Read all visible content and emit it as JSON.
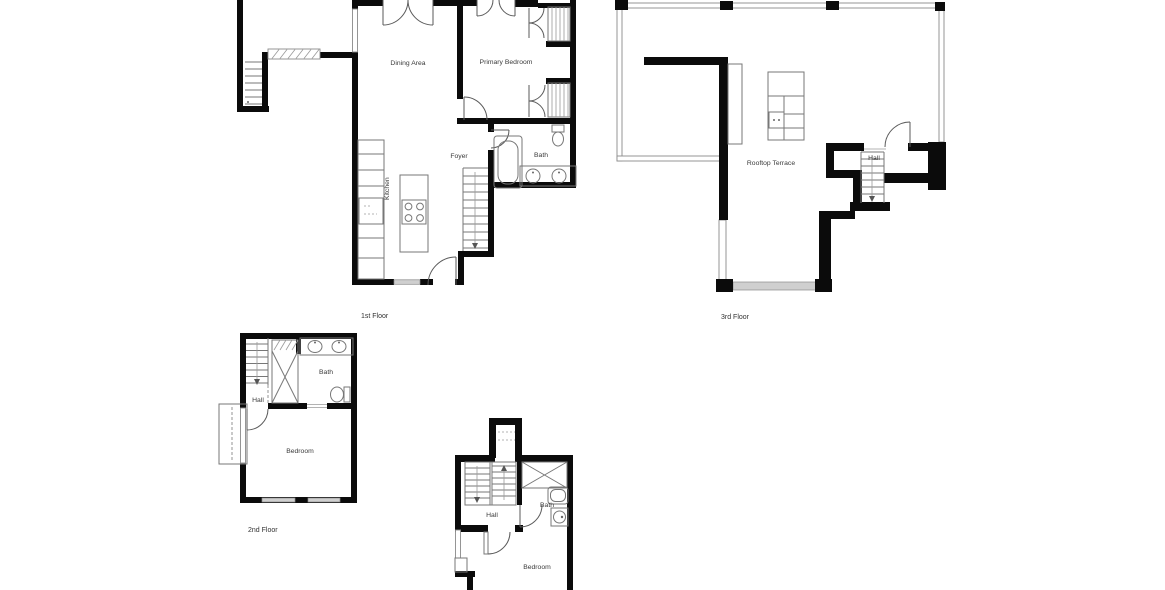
{
  "colors": {
    "background": "#ffffff",
    "wall": "#0b0b0b",
    "thin_line": "#777777",
    "window_fill": "#cfcfcf",
    "label_text": "#3a3a3a"
  },
  "floor1": {
    "label": "1st Floor",
    "rooms": {
      "dining_area": "Dining Area",
      "primary_bedroom": "Primary Bedroom",
      "kitchen": "Kitchen",
      "foyer": "Foyer",
      "bath": "Bath"
    }
  },
  "floor2": {
    "label": "2nd Floor",
    "rooms": {
      "hall": "Hall",
      "bath": "Bath",
      "bedroom": "Bedroom"
    }
  },
  "floor3": {
    "label": "3rd Floor",
    "rooms": {
      "rooftop_terrace": "Rooftop Terrace",
      "hall": "Hall"
    }
  },
  "floor4": {
    "rooms": {
      "hall": "Hall",
      "bath": "Bath",
      "bedroom": "Bedroom"
    }
  }
}
